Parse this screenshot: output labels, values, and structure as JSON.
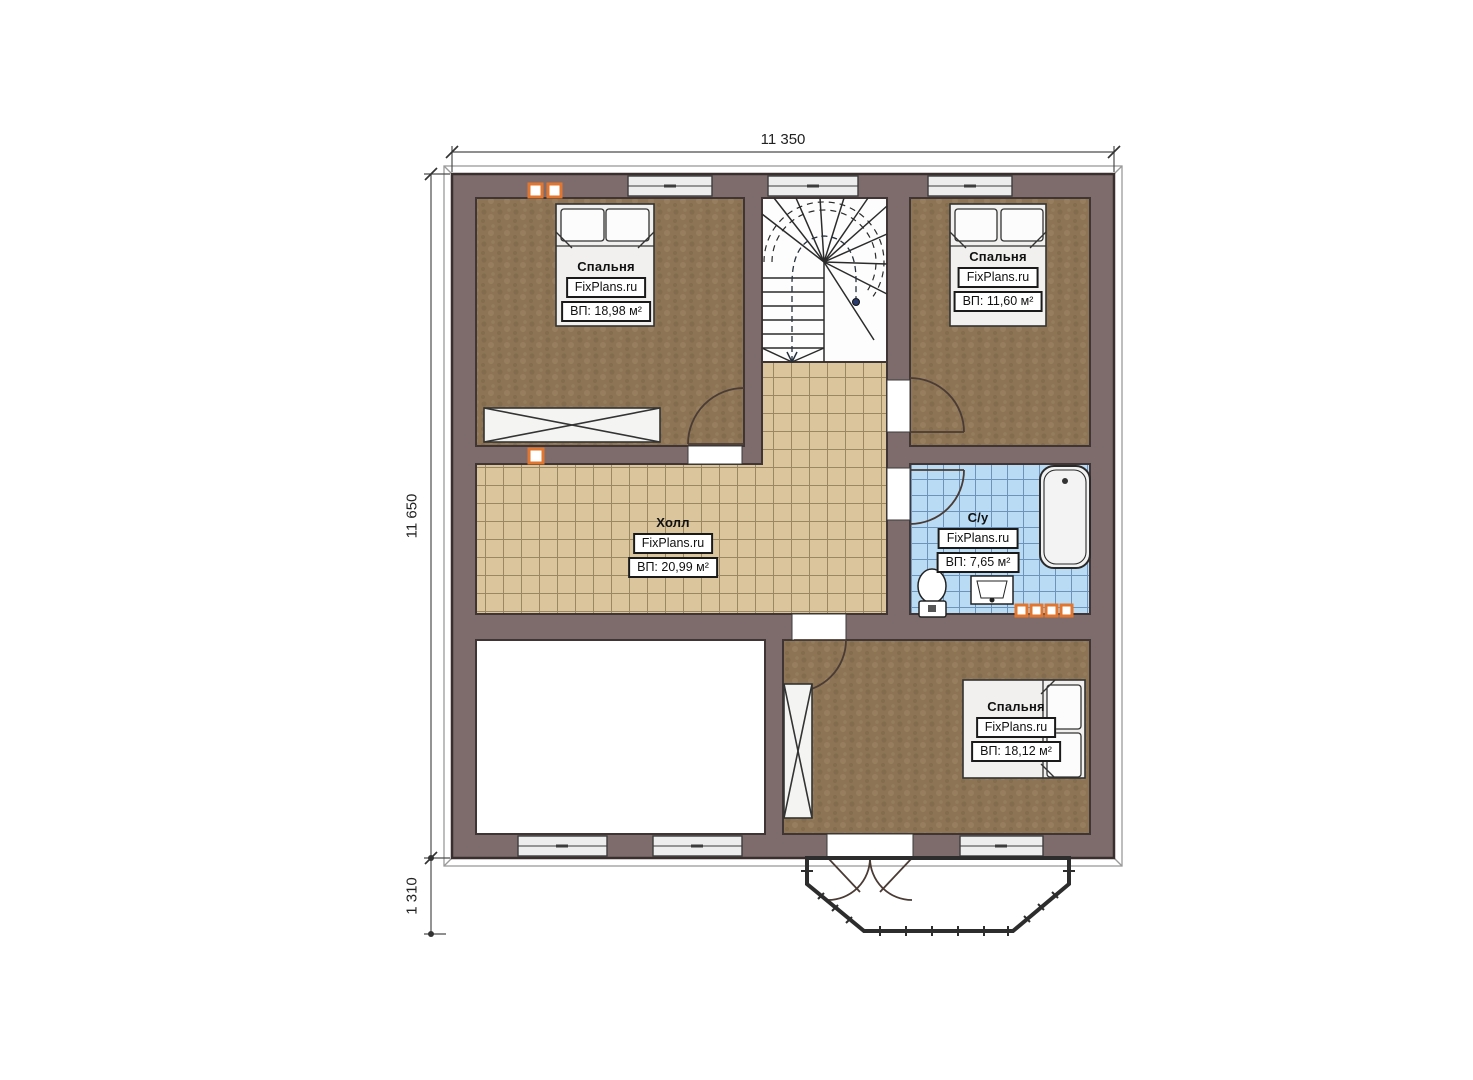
{
  "plan": {
    "title": "Второй этаж — план",
    "brand": "FixPlans.ru"
  },
  "dimensions": {
    "width_top": "11 350",
    "height_left": "11 650",
    "bay_depth": "1 310"
  },
  "rooms": {
    "bedroom_top_left": {
      "name": "Спальня",
      "brand": "FixPlans.ru",
      "area": "ВП: 18,98 м²"
    },
    "bedroom_top_right": {
      "name": "Спальня",
      "brand": "FixPlans.ru",
      "area": "ВП: 11,60 м²"
    },
    "hall": {
      "name": "Холл",
      "brand": "FixPlans.ru",
      "area": "ВП: 20,99 м²"
    },
    "bathroom": {
      "name": "С/у",
      "brand": "FixPlans.ru",
      "area": "ВП: 7,65 м²"
    },
    "bedroom_bottom": {
      "name": "Спальня",
      "brand": "FixPlans.ru",
      "area": "ВП: 18,12 м²"
    }
  },
  "colors": {
    "wall": "#7e6c6c",
    "carpet": "#8c7455",
    "hall_tile": "#dac59d",
    "bath_tile": "#badbf4",
    "vent_orange": "#e0762f"
  }
}
